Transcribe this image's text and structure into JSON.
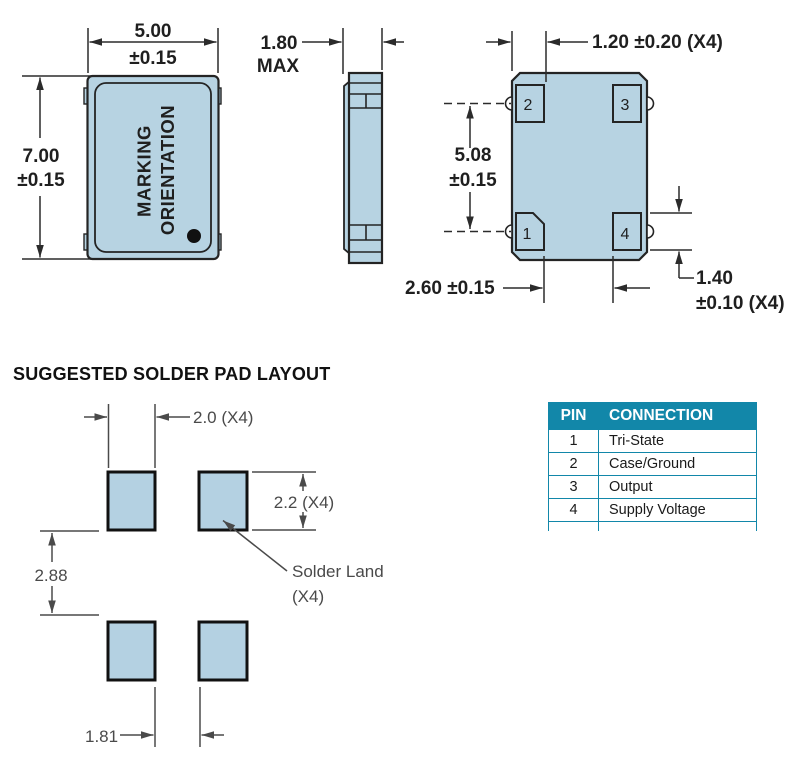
{
  "colors": {
    "package_fill": "#b7d3e2",
    "outline": "#242424",
    "dim_line": "#2b2b2b",
    "layout_dim_text": "#4a4a4a",
    "table_header_bg": "#1287a9",
    "table_border": "#1287a9"
  },
  "drawing": {
    "front_view": {
      "width_dim": {
        "value": "5.00",
        "tolerance": "±0.15"
      },
      "height_dim": {
        "value": "7.00",
        "tolerance": "±0.15"
      },
      "marking": {
        "line1": "MARKING",
        "line2": "ORIENTATION"
      }
    },
    "side_view": {
      "thickness_dim": {
        "value": "1.80",
        "qualifier": "MAX"
      }
    },
    "bottom_view": {
      "pad_width_dim": "1.20 ±0.20 (X4)",
      "pad_pitch_dim": {
        "value": "5.08",
        "tolerance": "±0.15"
      },
      "pad_gap_dim": "2.60 ±0.15",
      "pad_height_dim": {
        "value": "1.40",
        "tolerance": "±0.10 (X4)"
      },
      "pad_labels": {
        "p1": "1",
        "p2": "2",
        "p3": "3",
        "p4": "4"
      }
    }
  },
  "solder_layout": {
    "heading": "SUGGESTED SOLDER PAD LAYOUT",
    "pad_width_dim": "2.0 (X4)",
    "pad_height_dim": "2.2 (X4)",
    "vertical_gap_dim": "2.88",
    "horizontal_gap_dim": "1.81",
    "land_label": {
      "line1": "Solder Land",
      "line2": "(X4)"
    }
  },
  "pin_table": {
    "headers": {
      "pin": "PIN",
      "connection": "CONNECTION"
    },
    "rows": [
      {
        "pin": "1",
        "connection": "Tri-State"
      },
      {
        "pin": "2",
        "connection": "Case/Ground"
      },
      {
        "pin": "3",
        "connection": "Output"
      },
      {
        "pin": "4",
        "connection": "Supply Voltage"
      }
    ]
  }
}
